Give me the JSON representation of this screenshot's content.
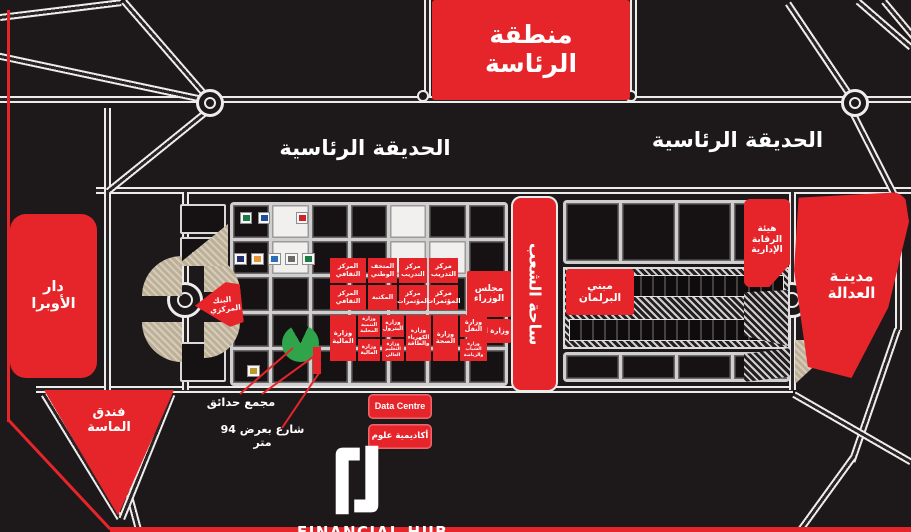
{
  "map": {
    "presidency_area": "منطقة الرئاسة",
    "garden_left": "الحديقة الرئاسية",
    "garden_right": "الحديقة الرئاسية",
    "opera_house": "دار الأوبرا",
    "almasa_hotel": "فندق الماسة",
    "justice_city": "مدينـة العدالة",
    "admin_control_authority": "هيئة الرقابة الإدارية",
    "peoples_square": "ساحة الشعب",
    "parliament_building": "مبني البرلمان",
    "cabinet": "مجلس الوزراء",
    "justice_ministry": "وزارة العدل",
    "central_bank": "البنك المركزي",
    "centers": [
      "المركز الثقافي",
      "المتحف الوطني",
      "مركز التدريب",
      "مركز التدريب",
      "المركز الثقافي",
      "المكتبة",
      "مركز المؤتمرات",
      "مركز المؤتمرات"
    ],
    "ministries": [
      "وزارة المالية",
      "وزارة التنمية المحلية",
      "وزارة المالية",
      "وزارة البترول",
      "وزارة التعليم العالي",
      "وزارة الكهرباء والطاقة",
      "وزارة الصحة",
      "وزارة النقل",
      "وزارة الشباب والرياضة"
    ],
    "gardens_complex": "مجمع حدائق",
    "street_note": "شارع بعرض 94 متر",
    "data_centre": "Data Centre",
    "science_academy": "أكاديمية علوم"
  },
  "logo": {
    "title": "FINANCIAL HUB",
    "subtitle": "NEW CAPITAL"
  },
  "colors": {
    "accent_red": "#e6252b",
    "map_black": "#1d1819",
    "road_white": "#ececec",
    "garden_green": "#2fa44b",
    "hatch_beige": "#d6ccb9"
  }
}
